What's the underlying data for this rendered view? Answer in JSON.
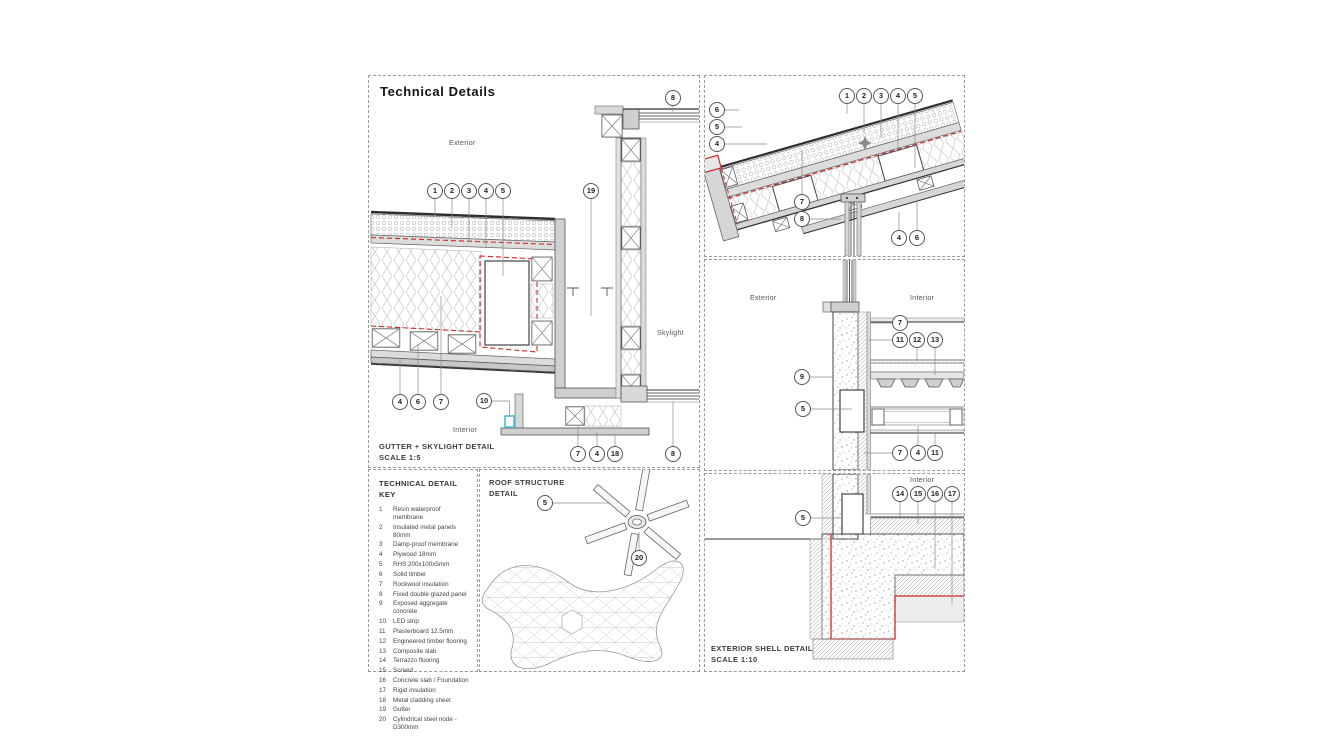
{
  "sheet": {
    "title": "Technical Details",
    "colors": {
      "red_outline": "#cc2a28",
      "led_cyan": "#45c2d4",
      "line": "#3f3f3f",
      "panel_border": "#9a9a9a"
    },
    "panels": {
      "gutter_skylight": {
        "caption_line1": "GUTTER + SKYLIGHT DETAIL",
        "caption_line2": "SCALE 1:5",
        "labels": {
          "exterior": "Exterior",
          "interior": "Interior",
          "skylight": "Skylight"
        },
        "callouts": [
          {
            "n": "1",
            "x": 66,
            "y": 115
          },
          {
            "n": "2",
            "x": 83,
            "y": 115
          },
          {
            "n": "3",
            "x": 100,
            "y": 115
          },
          {
            "n": "4",
            "x": 117,
            "y": 115
          },
          {
            "n": "5",
            "x": 134,
            "y": 115
          },
          {
            "n": "19",
            "x": 222,
            "y": 115
          },
          {
            "n": "8",
            "x": 304,
            "y": 22
          },
          {
            "n": "4",
            "x": 31,
            "y": 326
          },
          {
            "n": "6",
            "x": 49,
            "y": 326
          },
          {
            "n": "7",
            "x": 72,
            "y": 326
          },
          {
            "n": "10",
            "x": 115,
            "y": 325
          },
          {
            "n": "7",
            "x": 209,
            "y": 378
          },
          {
            "n": "4",
            "x": 228,
            "y": 378
          },
          {
            "n": "18",
            "x": 246,
            "y": 378
          },
          {
            "n": "8",
            "x": 304,
            "y": 378
          }
        ]
      },
      "key": {
        "title_line1": "TECHNICAL DETAIL",
        "title_line2": "KEY",
        "items": [
          {
            "num": "1",
            "text": "Resin waterproof membrane"
          },
          {
            "num": "2",
            "text": "Insulated metal panels 80mm"
          },
          {
            "num": "3",
            "text": "Damp-proof membrane"
          },
          {
            "num": "4",
            "text": "Plywood 18mm"
          },
          {
            "num": "5",
            "text": "RHS 200x100x5mm"
          },
          {
            "num": "6",
            "text": "Solid timber"
          },
          {
            "num": "7",
            "text": "Rockwool insulation"
          },
          {
            "num": "8",
            "text": "Fixed double glazed panel"
          },
          {
            "num": "9",
            "text": "Exposed aggregate concrete"
          },
          {
            "num": "10",
            "text": "LED strip"
          },
          {
            "num": "11",
            "text": "Plasterboard 12.5mm"
          },
          {
            "num": "12",
            "text": "Engineered timber flooring"
          },
          {
            "num": "13",
            "text": "Composite slab"
          },
          {
            "num": "14",
            "text": "Terrazzo flooring"
          },
          {
            "num": "15",
            "text": "Screed"
          },
          {
            "num": "16",
            "text": "Concrete slab / Foundation"
          },
          {
            "num": "17",
            "text": "Rigid insulation"
          },
          {
            "num": "18",
            "text": "Metal cladding sheet"
          },
          {
            "num": "19",
            "text": "Gutter"
          },
          {
            "num": "20",
            "text": "Cylindrical steel node - D300mm"
          }
        ]
      },
      "roof_structure": {
        "title_line1": "ROOF STRUCTURE",
        "title_line2": "DETAIL",
        "callouts": [
          {
            "n": "5",
            "x": 65,
            "y": 33
          },
          {
            "n": "20",
            "x": 159,
            "y": 88
          }
        ]
      },
      "roof_edge": {
        "callouts": [
          {
            "n": "1",
            "x": 142,
            "y": 20
          },
          {
            "n": "2",
            "x": 159,
            "y": 20
          },
          {
            "n": "3",
            "x": 176,
            "y": 20
          },
          {
            "n": "4",
            "x": 193,
            "y": 20
          },
          {
            "n": "5",
            "x": 210,
            "y": 20
          },
          {
            "n": "6",
            "x": 12,
            "y": 34
          },
          {
            "n": "5",
            "x": 12,
            "y": 51
          },
          {
            "n": "4",
            "x": 12,
            "y": 68
          },
          {
            "n": "7",
            "x": 97,
            "y": 126
          },
          {
            "n": "8",
            "x": 97,
            "y": 143
          },
          {
            "n": "4",
            "x": 194,
            "y": 162
          },
          {
            "n": "6",
            "x": 212,
            "y": 162
          }
        ]
      },
      "wall_section": {
        "labels": {
          "exterior": "Exterior",
          "interior": "Interior"
        },
        "callouts": [
          {
            "n": "7",
            "x": 195,
            "y": 63
          },
          {
            "n": "11",
            "x": 195,
            "y": 80
          },
          {
            "n": "12",
            "x": 212,
            "y": 80
          },
          {
            "n": "13",
            "x": 230,
            "y": 80
          },
          {
            "n": "9",
            "x": 97,
            "y": 117
          },
          {
            "n": "5",
            "x": 98,
            "y": 149
          },
          {
            "n": "7",
            "x": 195,
            "y": 193
          },
          {
            "n": "4",
            "x": 213,
            "y": 193
          },
          {
            "n": "11",
            "x": 230,
            "y": 193
          }
        ]
      },
      "shell": {
        "caption_line1": "EXTERIOR SHELL DETAIL",
        "caption_line2": "SCALE 1:10",
        "labels": {
          "interior": "Interior"
        },
        "callouts": [
          {
            "n": "5",
            "x": 98,
            "y": 44
          },
          {
            "n": "14",
            "x": 195,
            "y": 20
          },
          {
            "n": "15",
            "x": 213,
            "y": 20
          },
          {
            "n": "16",
            "x": 230,
            "y": 20
          },
          {
            "n": "17",
            "x": 247,
            "y": 20
          }
        ]
      }
    }
  }
}
